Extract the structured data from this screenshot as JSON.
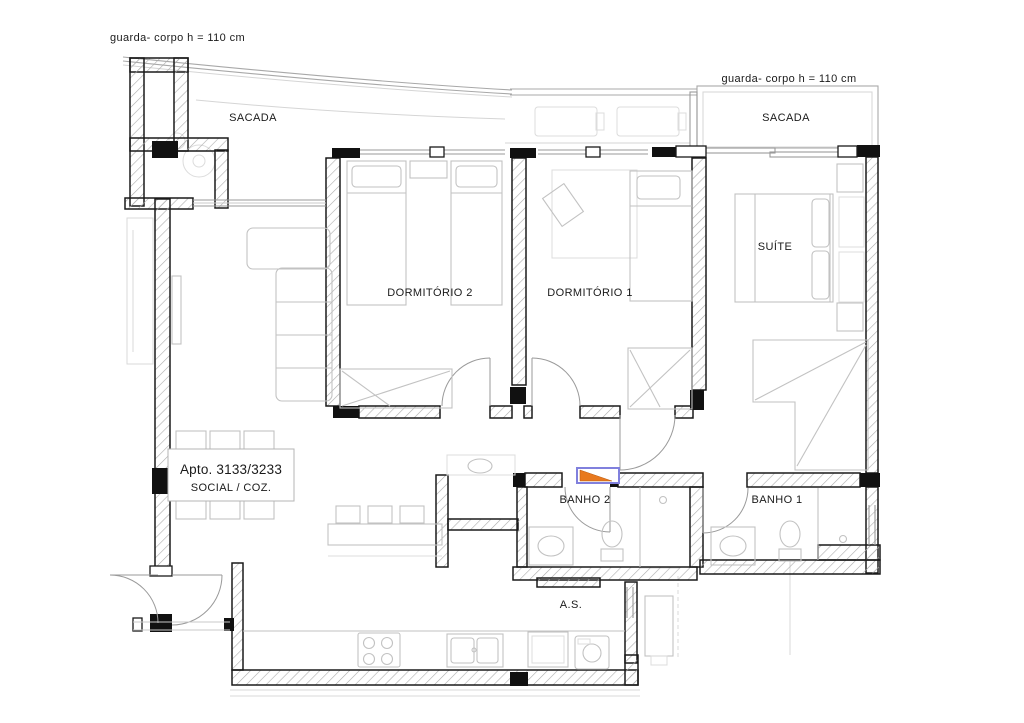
{
  "drawing": {
    "type": "apartment-floor-plan",
    "labels": {
      "guardrail_left": "guarda- corpo h = 110 cm",
      "guardrail_right": "guarda- corpo h = 110 cm",
      "balcony_left": "SACADA",
      "balcony_right": "SACADA",
      "bedroom2": "DORMITÓRIO 2",
      "bedroom1": "DORMITÓRIO 1",
      "suite": "SUÍTE",
      "apartment": "Apto. 3133/3233",
      "living_kitchen": "SOCIAL / COZ.",
      "bath2": "BANHO 2",
      "bath1": "BANHO 1",
      "service_area": "A.S."
    },
    "colors": {
      "background": "#ffffff",
      "wall": "#1a1a1a",
      "hatch": "#adadad",
      "furniture": "#c2c2c2",
      "faint": "#d9d9d9",
      "entry_marker_fill": "#e8791e",
      "entry_marker_border": "#8080dd",
      "text": "#1a1a1a"
    }
  }
}
